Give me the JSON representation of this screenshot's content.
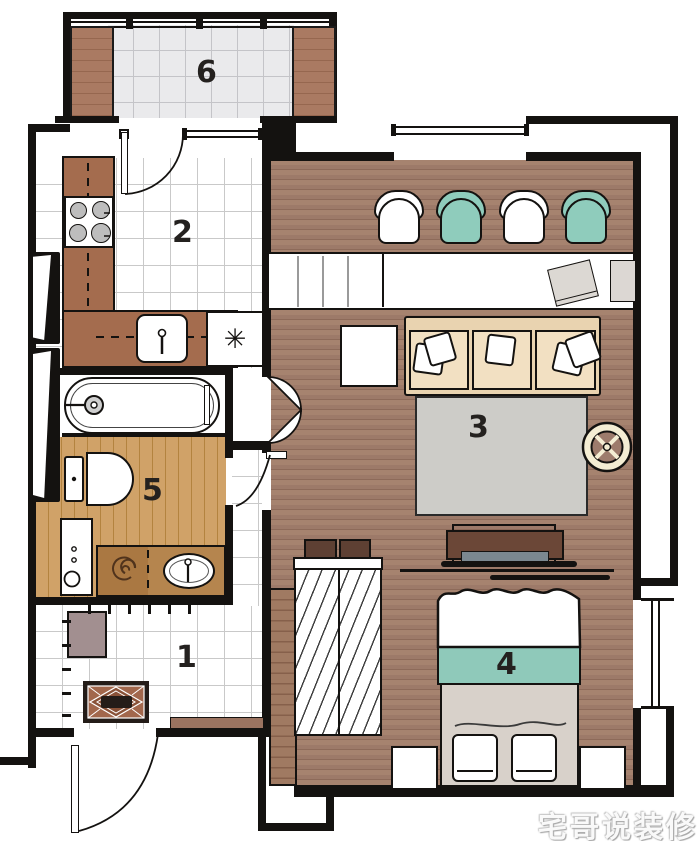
{
  "watermark": "宅哥说装修",
  "rooms": {
    "hallway": {
      "number": "1"
    },
    "kitchen": {
      "number": "2"
    },
    "living": {
      "number": "3"
    },
    "bedroom": {
      "number": "4"
    },
    "bathroom": {
      "number": "5"
    },
    "balcony": {
      "number": "6"
    }
  },
  "symbols": {
    "refrigerator": "✳"
  },
  "palette": {
    "wall": "#141210",
    "wood_dark": "#9d7a69",
    "wood_light": "#cda167",
    "counter_brown": "#a46c4e",
    "vanity_brown": "#b5854e",
    "teal": "#8fccbc",
    "sofa_beige": "#e9d3b0",
    "rug_gray": "#cdccc8",
    "mauve": "#a28f90",
    "cream": "#f4edd3",
    "bed_gray": "#d8d1ca"
  },
  "objects": {
    "balcony": [
      "planter-left",
      "planter-right",
      "glazed-window-wall"
    ],
    "kitchen": [
      "l-shaped-counter",
      "stove",
      "sink",
      "refrigerator",
      "balcony-door"
    ],
    "living": [
      "dining-chairs-x4",
      "long-desk",
      "laptop",
      "desk-chair",
      "side-table",
      "sofa",
      "throw-pillows",
      "rug",
      "round-side-table",
      "tv",
      "tv-console"
    ],
    "bedroom": [
      "sliding-wardrobe",
      "storage-boxes",
      "double-bed",
      "pillows-x2",
      "nightstand-left",
      "nightstand-right",
      "window"
    ],
    "bathroom": [
      "bathtub",
      "toilet",
      "washing-machine",
      "vanity-counter",
      "basin",
      "rolled-towel"
    ],
    "hallway": [
      "shoe-cabinet",
      "coat-hooks",
      "doormat",
      "bench",
      "entry-door"
    ]
  }
}
